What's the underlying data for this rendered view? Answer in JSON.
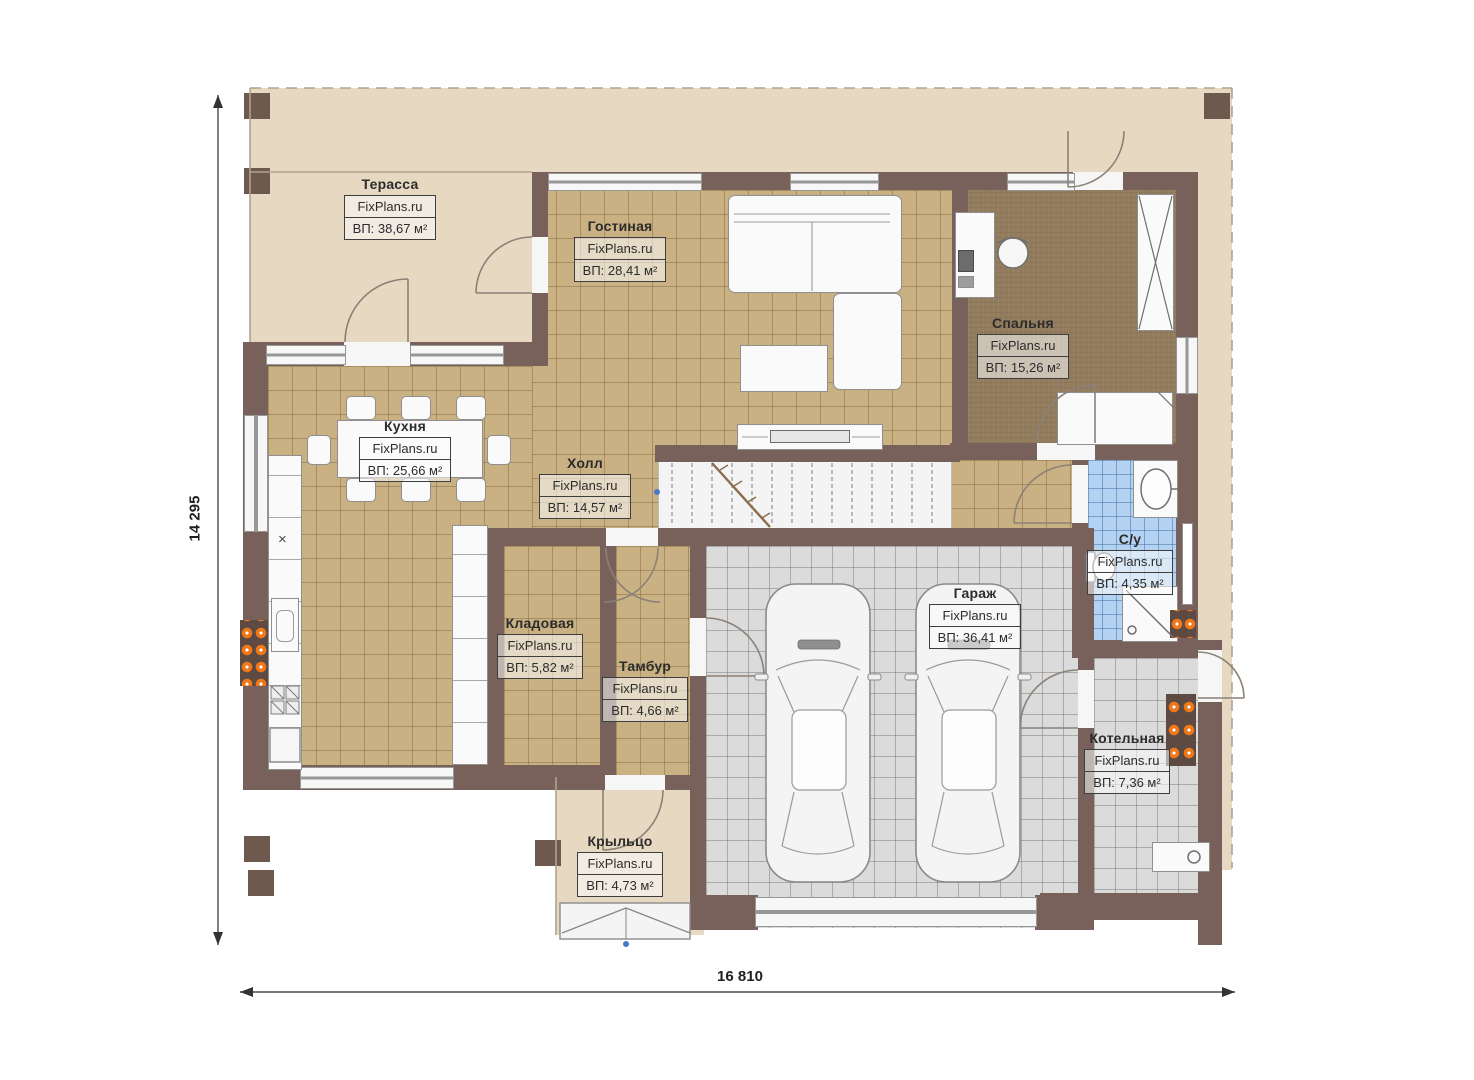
{
  "plan": {
    "watermark": "FixPlans.ru",
    "dimensions": {
      "width_label": "16 810",
      "height_label": "14 295"
    },
    "kitchen_counter_mark": "×",
    "rooms": [
      {
        "key": "terrace",
        "name": "Терасса",
        "area": "ВП: 38,67 м²"
      },
      {
        "key": "living",
        "name": "Гостиная",
        "area": "ВП: 28,41 м²"
      },
      {
        "key": "bedroom",
        "name": "Спальня",
        "area": "ВП: 15,26 м²"
      },
      {
        "key": "kitchen",
        "name": "Кухня",
        "area": "ВП: 25,66 м²"
      },
      {
        "key": "hall",
        "name": "Холл",
        "area": "ВП: 14,57 м²"
      },
      {
        "key": "wc",
        "name": "С/у",
        "area": "ВП: 4,35 м²"
      },
      {
        "key": "storage",
        "name": "Кладовая",
        "area": "ВП: 5,82 м²"
      },
      {
        "key": "vestibule",
        "name": "Тамбур",
        "area": "ВП: 4,66 м²"
      },
      {
        "key": "garage",
        "name": "Гараж",
        "area": "ВП: 36,41 м²"
      },
      {
        "key": "boiler",
        "name": "Котельная",
        "area": "ВП: 7,36 м²"
      },
      {
        "key": "porch",
        "name": "Крыльцо",
        "area": "ВП: 4,73 м²"
      }
    ],
    "colors": {
      "wall": "#77615a",
      "tile_tan": "#c9b183",
      "tile_gray": "#dbdbdb",
      "tile_blue": "#b4d3f2",
      "bedroom_floor": "#937c5e",
      "terrace": "#e7d8c2",
      "radiator_orange": "#f07818"
    }
  }
}
